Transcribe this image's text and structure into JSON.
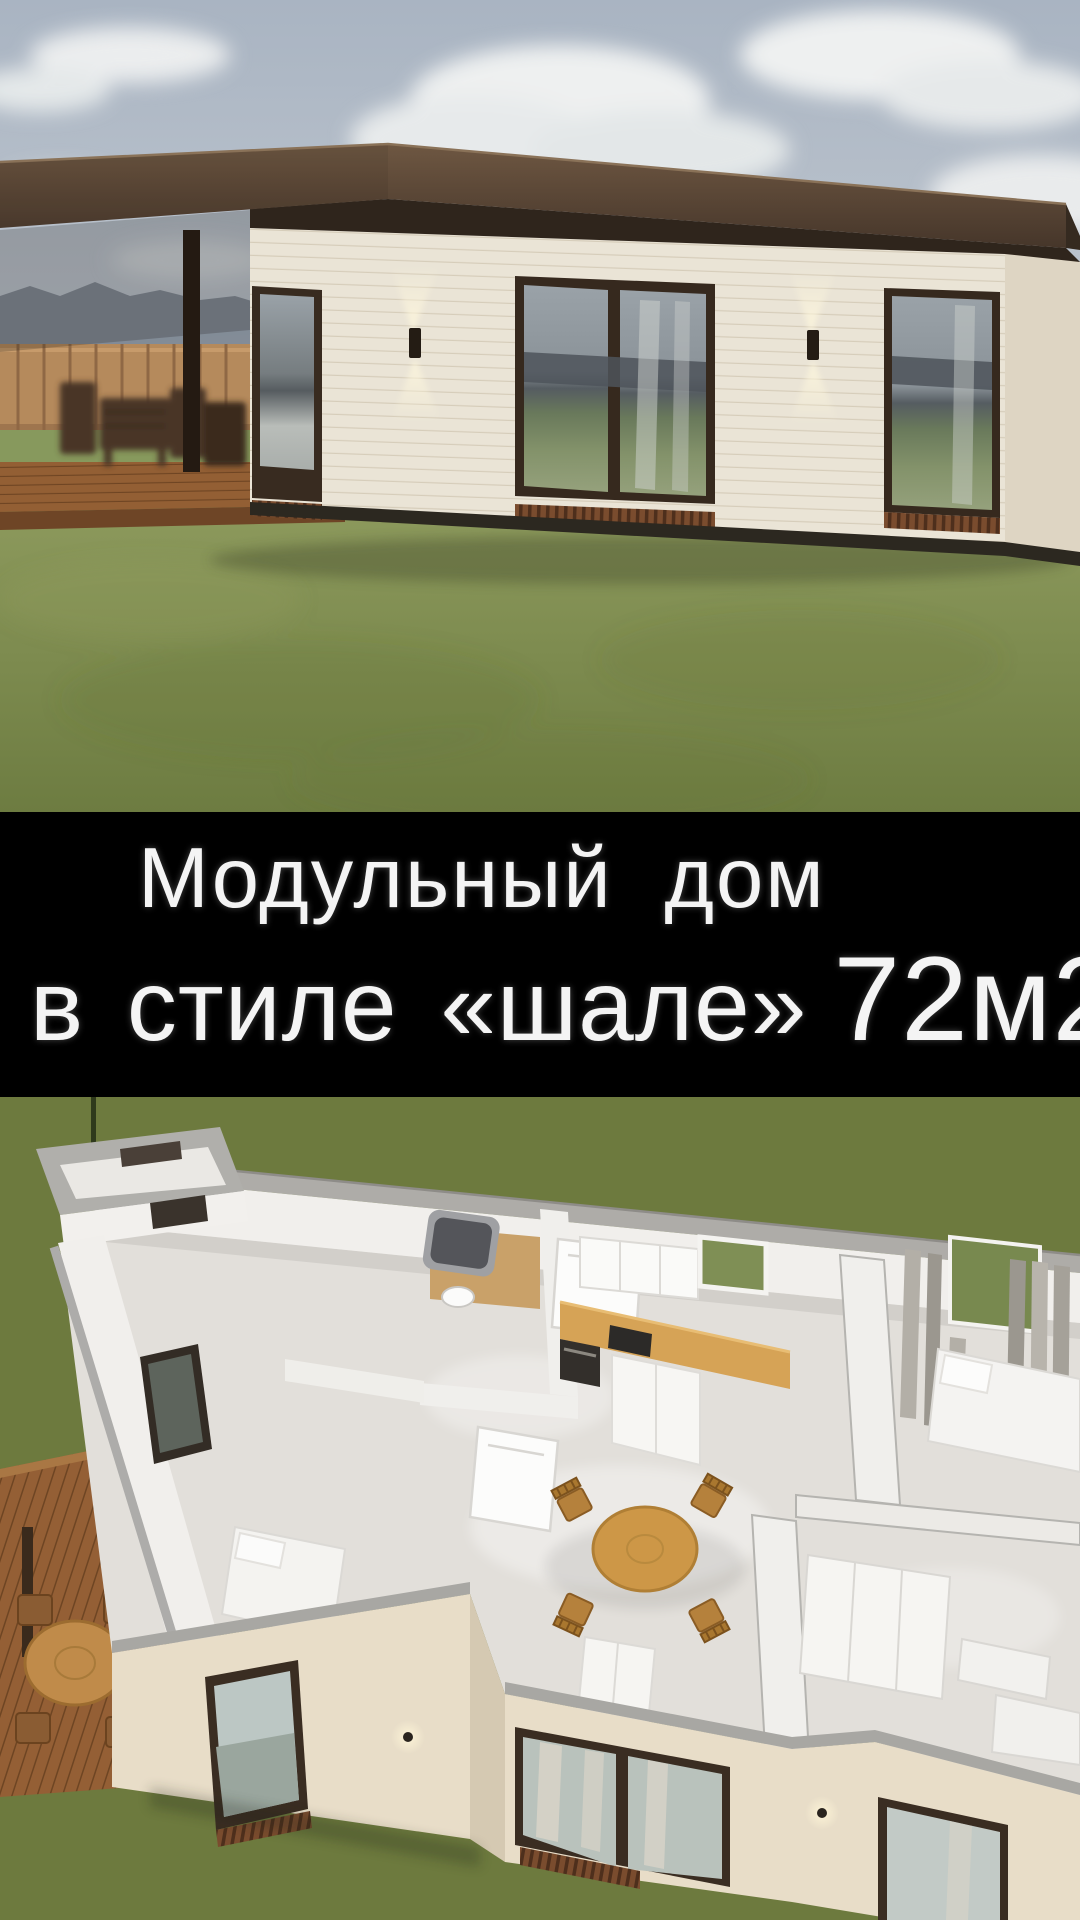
{
  "banner": {
    "line1": "Модульный дом",
    "line2": {
      "text": "в стиле «шале»",
      "area_value": "72м2"
    },
    "background": "#000000",
    "text_color": "#f4f4f4"
  },
  "scenes": {
    "exterior_render": {
      "label": "modular-house-exterior-3d-render",
      "colors": {
        "sky_top": "#a9b4c2",
        "sky_horizon": "#d8dadb",
        "cloud": "#eef0f0",
        "roof": "#5b4733",
        "wall_siding": "#eae4d6",
        "window_frame": "#36291e",
        "glass_hills": "#4d545a",
        "glass_grass": "#74855c",
        "deck_wood": "#935f34",
        "fence": "#b58a5c",
        "grass": "#7d8c52"
      }
    },
    "floorplan_render": {
      "label": "modular-house-floorplan-cutaway-3d-render",
      "colors": {
        "lawn": "#6d7a3e",
        "wall_top": "#aeaca8",
        "wall_face": "#f1efec",
        "floor": "#e2dfda",
        "kitchen_counter": "#d6a356",
        "dining_table": "#cd9747",
        "curtain": "#a9a59d",
        "front_wall": "#e8ddc8",
        "bath_floor": "#c9a169",
        "deck_wood": "#945f35"
      }
    }
  }
}
